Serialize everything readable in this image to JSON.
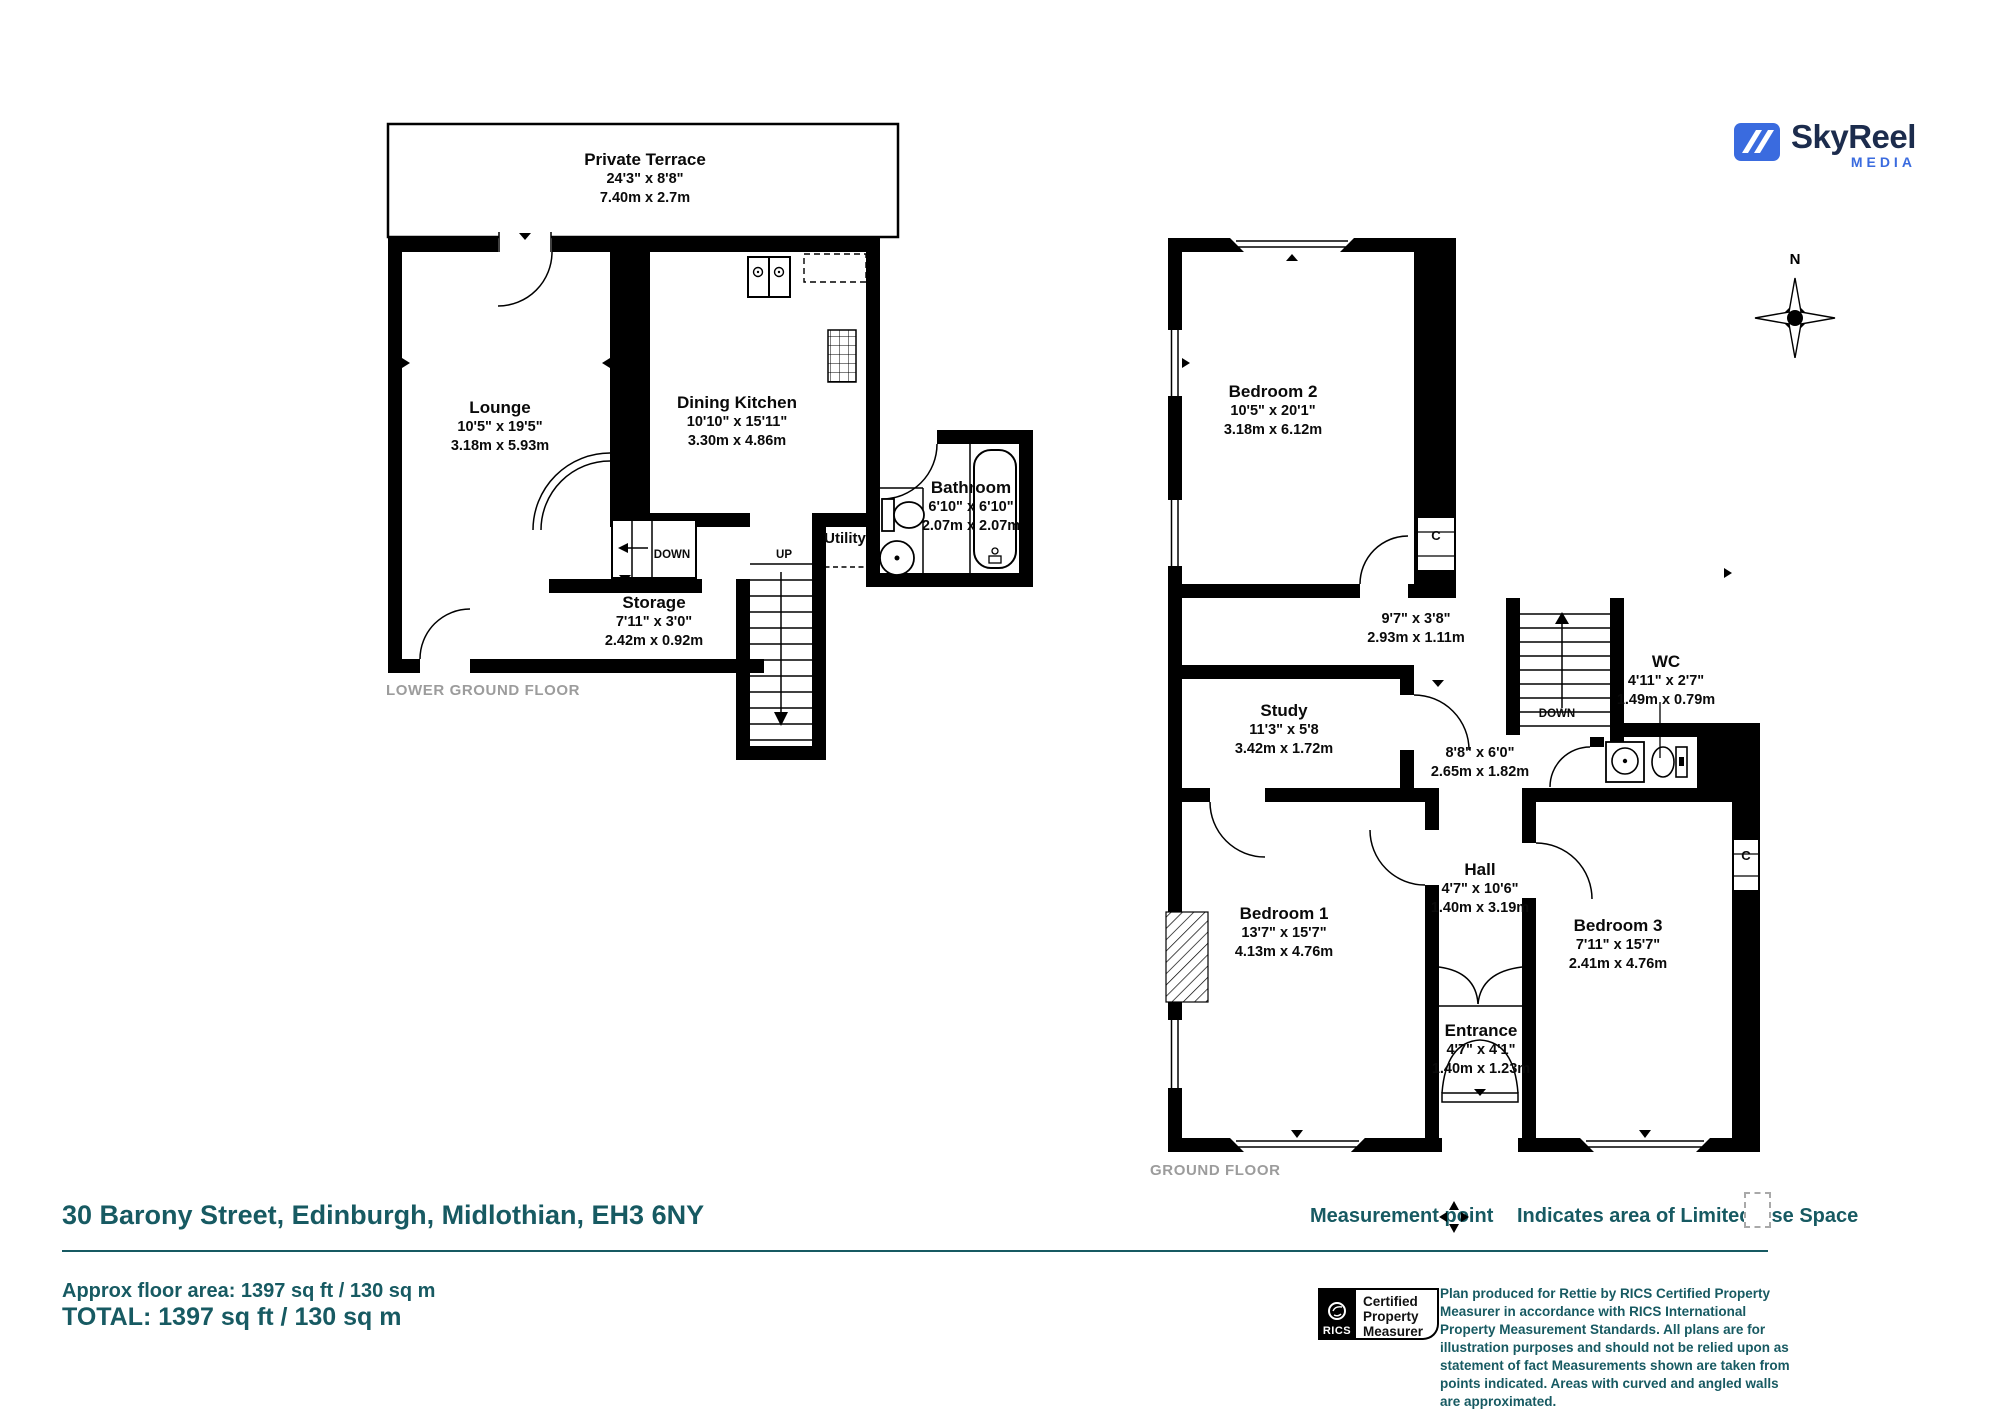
{
  "branding": {
    "name": "SkyReel",
    "tagline": "MEDIA"
  },
  "compass": {
    "north": "N"
  },
  "colors": {
    "teal": "#175A62",
    "plan_gray": "#9C9C9C",
    "brand_navy": "#1C2C4D",
    "brand_blue": "#3A6BDF"
  },
  "floors": {
    "lower": {
      "title": "LOWER GROUND FLOOR",
      "rooms": {
        "terrace": {
          "name": "Private Terrace",
          "imperial": "24'3\" x 8'8\"",
          "metric": "7.40m x 2.7m"
        },
        "lounge": {
          "name": "Lounge",
          "imperial": "10'5\" x 19'5\"",
          "metric": "3.18m x 5.93m"
        },
        "dining_kitchen": {
          "name": "Dining Kitchen",
          "imperial": "10'10\" x 15'11\"",
          "metric": "3.30m x 4.86m"
        },
        "bathroom": {
          "name": "Bathroom",
          "imperial": "6'10\" x 6'10\"",
          "metric": "2.07m x 2.07m"
        },
        "utility": {
          "name": "Utility"
        },
        "storage": {
          "name": "Storage",
          "imperial": "7'11\" x 3'0\"",
          "metric": "2.42m x 0.92m"
        }
      },
      "stairs": {
        "down": "DOWN",
        "up": "UP"
      }
    },
    "ground": {
      "title": "GROUND FLOOR",
      "rooms": {
        "bedroom2": {
          "name": "Bedroom 2",
          "imperial": "10'5\" x 20'1\"",
          "metric": "3.18m x 6.12m"
        },
        "landing": {
          "imperial": "9'7\" x 3'8\"",
          "metric": "2.93m x 1.11m"
        },
        "wc": {
          "name": "WC",
          "imperial": "4'11\" x 2'7\"",
          "metric": "1.49m x 0.79m"
        },
        "study": {
          "name": "Study",
          "imperial": "11'3\" x 5'8",
          "metric": "3.42m x 1.72m"
        },
        "inner_hall": {
          "imperial": "8'8\" x 6'0\"",
          "metric": "2.65m x 1.82m"
        },
        "bedroom1": {
          "name": "Bedroom 1",
          "imperial": "13'7\" x 15'7\"",
          "metric": "4.13m x 4.76m"
        },
        "hall": {
          "name": "Hall",
          "imperial": "4'7\" x 10'6\"",
          "metric": "1.40m x 3.19m"
        },
        "bedroom3": {
          "name": "Bedroom 3",
          "imperial": "7'11\" x 15'7\"",
          "metric": "2.41m x 4.76m"
        },
        "entrance": {
          "name": "Entrance",
          "imperial": "4'7\" x 4'1\"",
          "metric": "1.40m x 1.23m"
        },
        "cupboard1": "C",
        "cupboard2": "C"
      },
      "stairs": {
        "down": "DOWN"
      }
    }
  },
  "footer": {
    "address": "30 Barony Street, Edinburgh, Midlothian, EH3 6NY",
    "approx_area": "Approx floor area: 1397 sq ft / 130 sq m",
    "total": "TOTAL: 1397 sq ft / 130 sq m",
    "legend": {
      "measurement_point": "Measurement point",
      "limited_use": "Indicates area of  Limited Use Space"
    },
    "rics_badge": {
      "org": "RICS",
      "line1": "Certified",
      "line2": "Property",
      "line3": "Measurer"
    },
    "disclaimer": "Plan produced for Rettie by RICS Certified Property Measurer in accordance with RICS International Property Measurement Standards. All plans are for illustration purposes and should not be relied upon as statement of fact Measurements shown are taken from points indicated. Areas with curved and angled walls are approximated."
  }
}
